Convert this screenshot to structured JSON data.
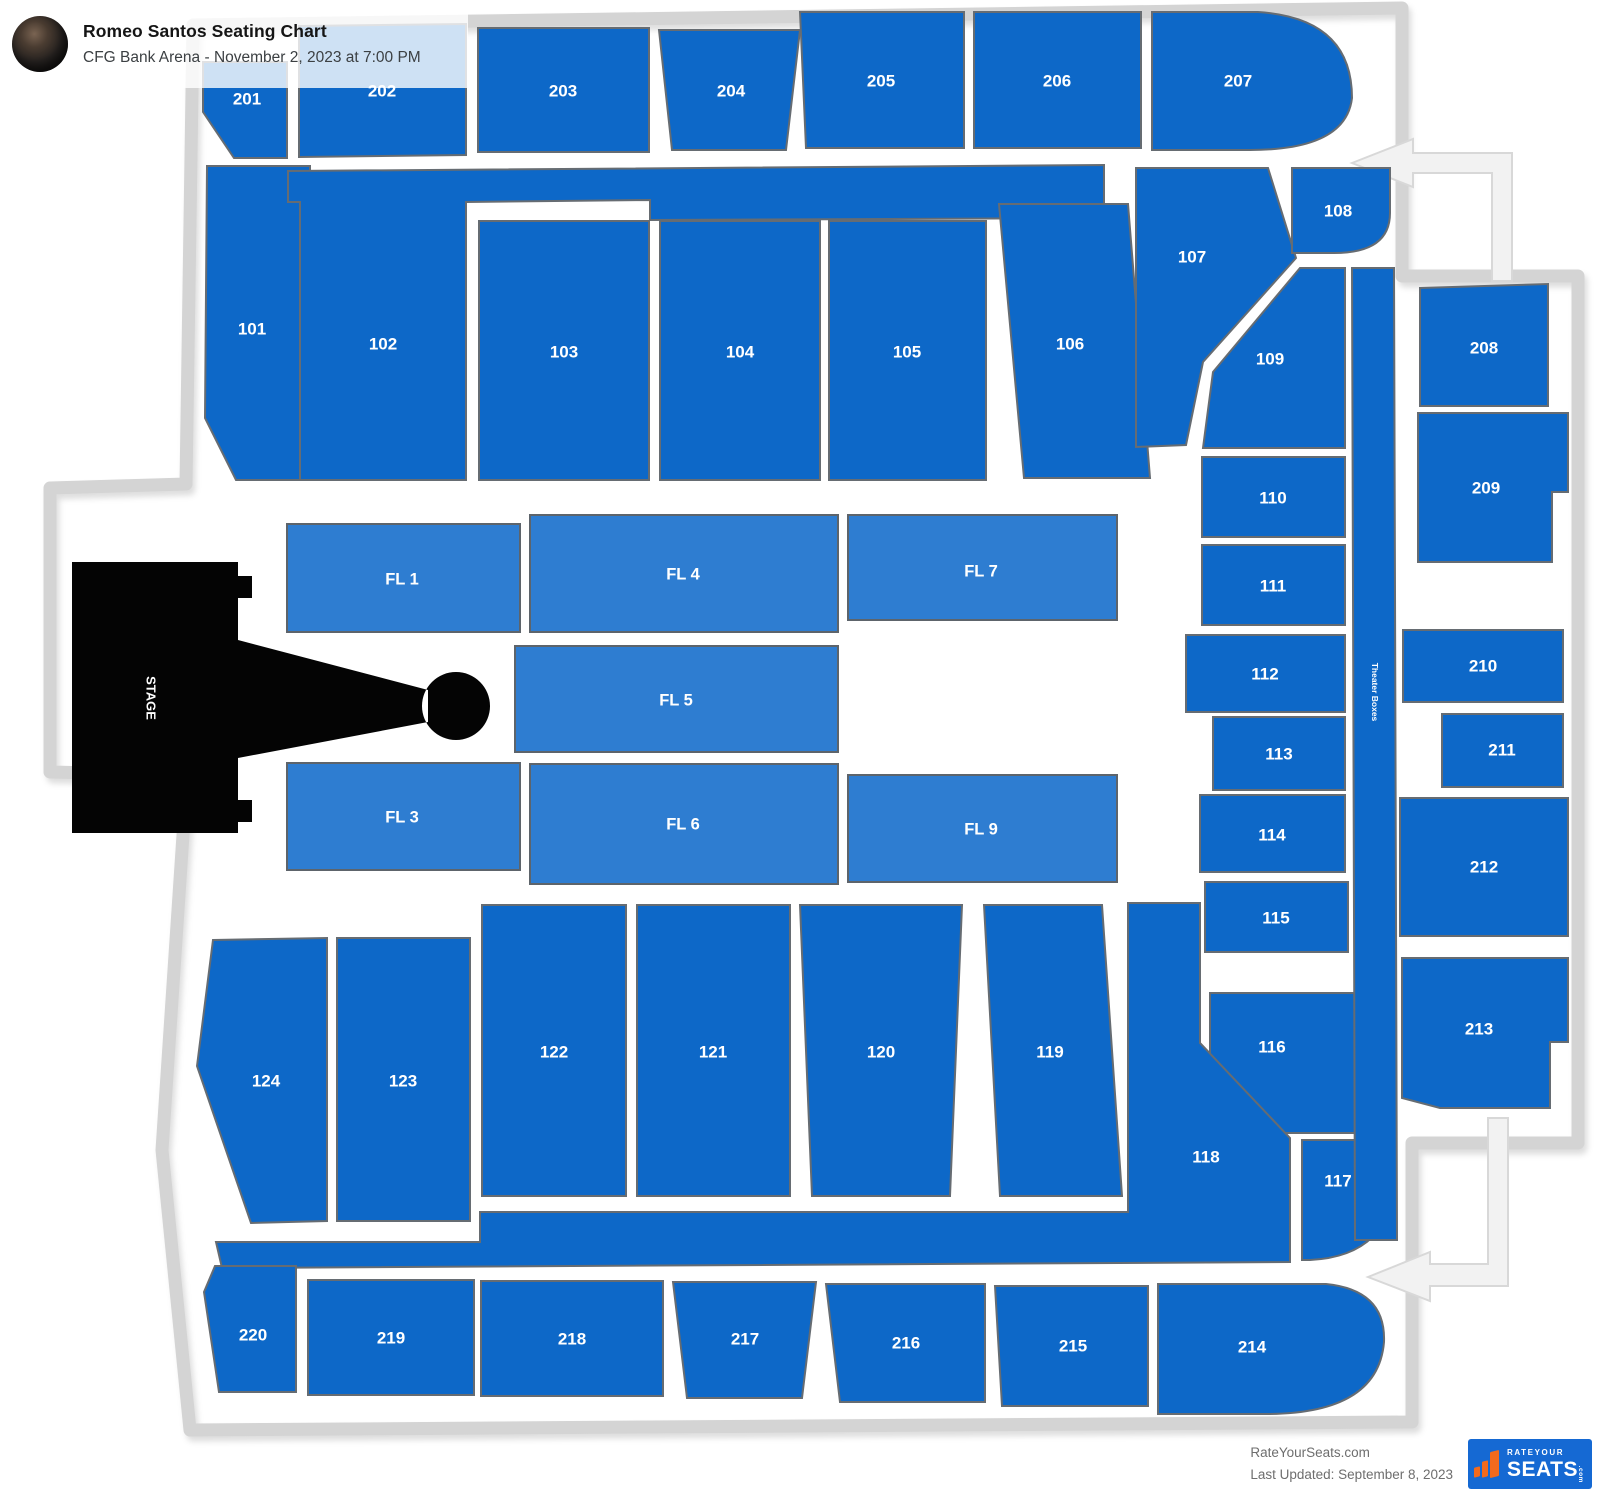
{
  "header": {
    "title": "Romeo Santos Seating Chart",
    "subtitle": "CFG Bank Arena - November 2, 2023 at 7:00 PM"
  },
  "footer": {
    "site": "RateYourSeats.com",
    "updated": "Last Updated: September 8, 2023",
    "logo": {
      "top": "RATEYOUR",
      "main": "SEATS",
      "suffix": ".com"
    }
  },
  "colors": {
    "tier": "#0d68c8",
    "tier_border": "#666c72",
    "floor": "#2e7dd1",
    "floor_border": "#5d646b",
    "stage": "#040404",
    "outline": "#d4d4d4",
    "arrow_fill": "#f2f2f2",
    "arrow_border": "#d8d8d8",
    "label": "#ffffff"
  },
  "map": {
    "outline_path": "M193,25 L1402,8 L1402,276 L1578,276 L1578,1143 L1412,1143 L1412,1422 L190,1430 L162,1150 L186,790 L186,775 L50,772 L50,488 L186,484 Z",
    "arrows": [
      {
        "name": "entrance-arrow-top",
        "points": "1352,163 1413,139 1413,153 1512,153 1512,281 1492,281 1492,173 1413,173 1413,187"
      },
      {
        "name": "entrance-arrow-bottom",
        "points": "1368,1277 1430,1252 1430,1264 1488,1264 1488,1118 1508,1118 1508,1286 1430,1286 1430,1301"
      }
    ],
    "sections": [
      {
        "label": "201",
        "cat": "tier",
        "points": "203,62 287,62 287,158 234,158 203,112",
        "lx": 247,
        "ly": 100
      },
      {
        "label": "202",
        "cat": "tier",
        "points": "299,26 466,24 466,155 299,157",
        "lx": 382,
        "ly": 92
      },
      {
        "label": "203",
        "cat": "tier",
        "points": "478,28 649,28 649,152 478,152",
        "lx": 563,
        "ly": 92
      },
      {
        "label": "204",
        "cat": "tier",
        "points": "659,30 800,30 786,150 672,150",
        "lx": 731,
        "ly": 92
      },
      {
        "label": "205",
        "cat": "tier",
        "points": "800,12 964,12 964,148 806,148",
        "lx": 881,
        "ly": 82
      },
      {
        "label": "206",
        "cat": "tier",
        "points": "974,12 1141,12 1141,148 974,148",
        "lx": 1057,
        "ly": 82
      },
      {
        "label": "207",
        "cat": "tier",
        "path": "M1152,12 L1258,12 Q1352,18 1352,98 Q1346,150 1250,150 L1152,150 Z",
        "lx": 1238,
        "ly": 82
      },
      {
        "label": "101",
        "cat": "tier",
        "points": "207,166 310,166 310,480 236,480 205,418",
        "lx": 252,
        "ly": 330
      },
      {
        "label": "102",
        "cat": "tier",
        "points": "288,171 1104,165 1104,218 650,220 650,200 466,202 466,480 300,480 300,202 288,202",
        "lx": 383,
        "ly": 345
      },
      {
        "label": "103",
        "cat": "tier",
        "points": "479,221 649,221 649,480 479,480",
        "lx": 564,
        "ly": 353
      },
      {
        "label": "104",
        "cat": "tier",
        "points": "660,221 820,221 820,480 660,480",
        "lx": 740,
        "ly": 353
      },
      {
        "label": "105",
        "cat": "tier",
        "points": "829,221 986,221 986,480 829,480",
        "lx": 907,
        "ly": 353
      },
      {
        "label": "106",
        "cat": "tier",
        "points": "999,204 1128,204 1150,478 1024,478",
        "lx": 1070,
        "ly": 345
      },
      {
        "label": "107",
        "cat": "tier",
        "points": "1136,168 1268,168 1296,258 1203,362 1186,445 1136,447",
        "lx": 1192,
        "ly": 258
      },
      {
        "label": "108",
        "cat": "tier",
        "path": "M1292,168 L1390,168 L1390,213 Q1390,253 1334,253 L1292,253 Z",
        "lx": 1338,
        "ly": 212
      },
      {
        "label": "109",
        "cat": "tier",
        "points": "1213,372 1300,268 1345,268 1345,448 1203,448",
        "lx": 1270,
        "ly": 360
      },
      {
        "label": "110",
        "cat": "tier",
        "points": "1202,457 1345,457 1345,537 1202,537",
        "lx": 1273,
        "ly": 499
      },
      {
        "label": "111",
        "cat": "tier",
        "points": "1202,545 1345,545 1345,625 1202,625",
        "lx": 1273,
        "ly": 587
      },
      {
        "label": "112",
        "cat": "tier",
        "points": "1186,635 1345,635 1345,712 1186,712",
        "lx": 1265,
        "ly": 675
      },
      {
        "label": "113",
        "cat": "tier",
        "points": "1213,717 1345,717 1345,790 1213,790",
        "lx": 1279,
        "ly": 755
      },
      {
        "label": "114",
        "cat": "tier",
        "points": "1200,795 1345,795 1345,872 1200,872",
        "lx": 1272,
        "ly": 836
      },
      {
        "label": "115",
        "cat": "tier",
        "points": "1205,882 1348,882 1348,952 1205,952",
        "lx": 1276,
        "ly": 919
      },
      {
        "label": "116",
        "cat": "tier",
        "points": "1210,993 1362,993 1362,1133 1262,1133 1210,1060",
        "lx": 1272,
        "ly": 1048
      },
      {
        "label": "117",
        "cat": "tier",
        "path": "M1302,1140 L1370,1140 Q1397,1142 1396,1176 Q1392,1256 1310,1260 L1302,1260 Z",
        "lx": 1338,
        "ly": 1182
      },
      {
        "label": "118",
        "cat": "tier",
        "path": "M216,1242 L480,1242 L480,1212 L1128,1212 L1128,903 L1200,903 L1200,1043 L1290,1138 L1290,1262 L222,1268 Z",
        "lx": 1206,
        "ly": 1158
      },
      {
        "label": "119",
        "cat": "tier",
        "points": "984,905 1102,905 1122,1196 1000,1196",
        "lx": 1050,
        "ly": 1053
      },
      {
        "label": "120",
        "cat": "tier",
        "points": "800,905 962,905 950,1196 812,1196",
        "lx": 881,
        "ly": 1053
      },
      {
        "label": "121",
        "cat": "tier",
        "points": "637,905 790,905 790,1196 637,1196",
        "lx": 713,
        "ly": 1053
      },
      {
        "label": "122",
        "cat": "tier",
        "points": "482,905 626,905 626,1196 482,1196",
        "lx": 554,
        "ly": 1053
      },
      {
        "label": "123",
        "cat": "tier",
        "points": "337,938 470,938 470,1221 337,1221",
        "lx": 403,
        "ly": 1082
      },
      {
        "label": "124",
        "cat": "tier",
        "points": "213,940 327,938 327,1221 251,1223 197,1066",
        "lx": 266,
        "ly": 1082
      },
      {
        "label": "208",
        "cat": "tier",
        "points": "1420,288 1548,284 1548,406 1420,406",
        "lx": 1484,
        "ly": 349
      },
      {
        "label": "209",
        "cat": "tier",
        "points": "1418,413 1568,413 1568,492 1552,492 1552,562 1418,562",
        "lx": 1486,
        "ly": 489
      },
      {
        "label": "210",
        "cat": "tier",
        "points": "1403,630 1563,630 1563,702 1403,702",
        "lx": 1483,
        "ly": 667
      },
      {
        "label": "211",
        "cat": "tier",
        "points": "1442,714 1563,714 1563,787 1442,787",
        "lx": 1502,
        "ly": 751
      },
      {
        "label": "212",
        "cat": "tier",
        "points": "1400,798 1568,798 1568,936 1400,936",
        "lx": 1484,
        "ly": 868
      },
      {
        "label": "213",
        "cat": "tier",
        "points": "1402,958 1568,958 1568,1042 1550,1042 1550,1108 1440,1108 1402,1098",
        "lx": 1479,
        "ly": 1030
      },
      {
        "label": "214",
        "cat": "tier",
        "path": "M1158,1284 L1326,1284 Q1386,1290 1384,1342 Q1378,1414 1266,1414 L1158,1414 Z",
        "lx": 1252,
        "ly": 1348
      },
      {
        "label": "215",
        "cat": "tier",
        "points": "995,1286 1148,1286 1148,1406 1002,1406",
        "lx": 1073,
        "ly": 1347
      },
      {
        "label": "216",
        "cat": "tier",
        "points": "826,1284 985,1284 985,1402 840,1402",
        "lx": 906,
        "ly": 1344
      },
      {
        "label": "217",
        "cat": "tier",
        "points": "673,1282 816,1282 802,1398 687,1398",
        "lx": 745,
        "ly": 1340
      },
      {
        "label": "218",
        "cat": "tier",
        "points": "481,1281 663,1281 663,1396 481,1396",
        "lx": 572,
        "ly": 1340
      },
      {
        "label": "219",
        "cat": "tier",
        "points": "308,1280 474,1280 474,1395 308,1395",
        "lx": 391,
        "ly": 1339
      },
      {
        "label": "220",
        "cat": "tier",
        "points": "215,1266 296,1266 296,1392 219,1392 204,1292",
        "lx": 253,
        "ly": 1336
      },
      {
        "label": "FL 1",
        "cat": "floor",
        "points": "287,524 520,524 520,632 287,632",
        "lx": 402,
        "ly": 580
      },
      {
        "label": "FL 4",
        "cat": "floor",
        "points": "530,515 838,515 838,632 530,632",
        "lx": 683,
        "ly": 575
      },
      {
        "label": "FL 7",
        "cat": "floor",
        "points": "848,515 1117,515 1117,620 848,620",
        "lx": 981,
        "ly": 572
      },
      {
        "label": "FL 5",
        "cat": "floor",
        "points": "515,646 838,646 838,752 515,752",
        "lx": 676,
        "ly": 701
      },
      {
        "label": "FL 3",
        "cat": "floor",
        "points": "287,763 520,763 520,870 287,870",
        "lx": 402,
        "ly": 818
      },
      {
        "label": "FL 6",
        "cat": "floor",
        "points": "530,764 838,764 838,884 530,884",
        "lx": 683,
        "ly": 825
      },
      {
        "label": "FL 9",
        "cat": "floor",
        "points": "848,775 1117,775 1117,882 848,882",
        "lx": 981,
        "ly": 830
      },
      {
        "name": "theater-boxes",
        "label": "Theater Boxes",
        "cat": "tier",
        "points": "1352,268 1394,268 1397,1240 1355,1240",
        "lx": 1374,
        "ly": 692,
        "rot": 90,
        "fs": 8.5
      },
      {
        "name": "stage",
        "label": "STAGE",
        "cat": "stage",
        "path": "M72,562 L238,562 L238,576 L252,576 L252,598 L238,598 L238,640 L428,690 L428,722 L238,758 L238,800 L252,800 L252,822 L238,822 L238,833 L72,833 Z M422,706 a34,34 0 1 0 68,0 a34,34 0 1 0 -68,0 Z",
        "lx": 150,
        "ly": 698,
        "rot": 90,
        "fs": 13
      }
    ]
  }
}
